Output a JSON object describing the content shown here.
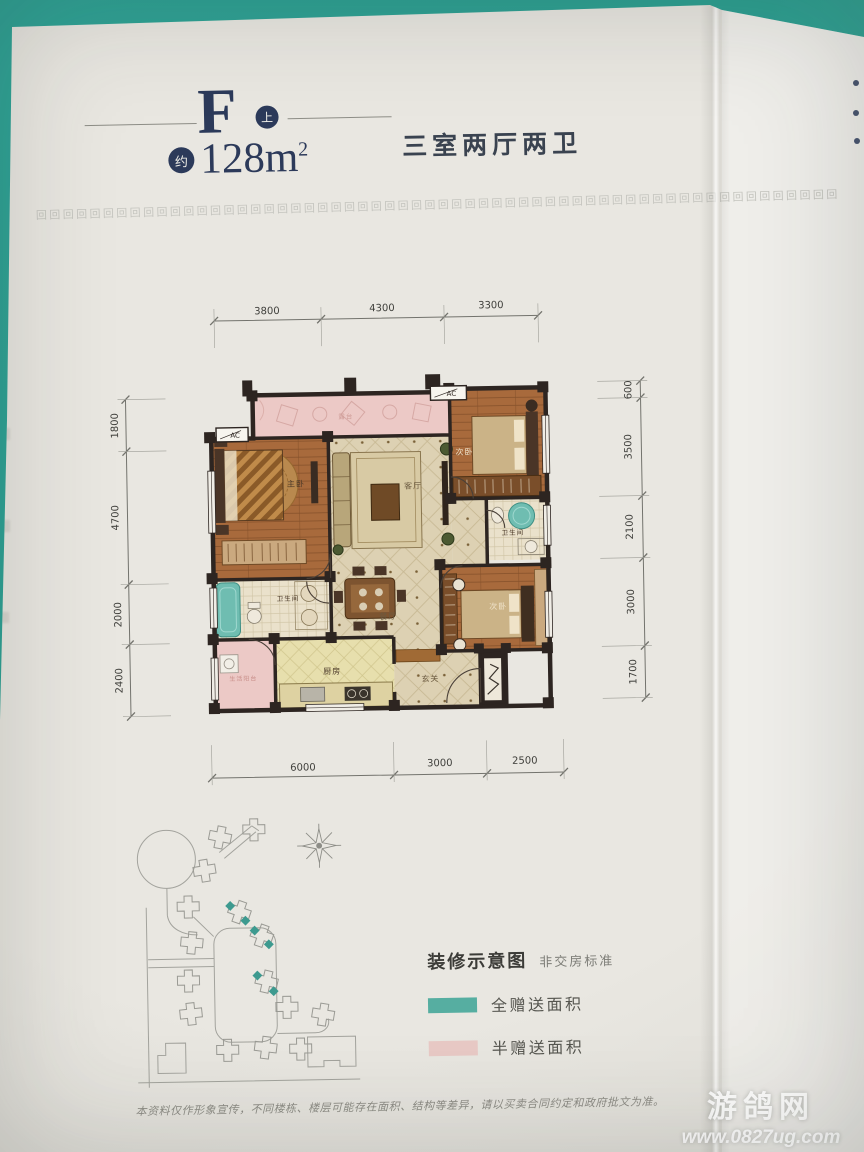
{
  "page": {
    "unit": {
      "letter": "F",
      "badge": "上",
      "approx_badge": "约",
      "area_value": "128m",
      "area_sup": "2",
      "layout_desc": "三室两厅两卫"
    },
    "border": {
      "char": "回",
      "count": 60
    },
    "dims": {
      "top": [
        "3800",
        "4300",
        "3300"
      ],
      "left": [
        "1800",
        "4700",
        "2000",
        "2400"
      ],
      "right": [
        "600",
        "3500",
        "2100",
        "3000",
        "1700"
      ],
      "bottom": [
        "6000",
        "3000",
        "2500"
      ]
    },
    "plan": {
      "ac": "AC",
      "rooms": {
        "terrace": "露台",
        "master": "主卧",
        "living": "客厅",
        "dining": "餐厅",
        "kitchen": "厨房",
        "entry": "玄关",
        "utility": "生活阳台",
        "bath_left": "卫生间",
        "bath_right": "卫生间",
        "bed_top_right": "次卧",
        "bed_bottom_right": "次卧"
      }
    },
    "legend": {
      "title": "装修示意图",
      "subtitle": "非交房标准",
      "items": [
        {
          "label": "全赠送面积",
          "color": "#56aea1"
        },
        {
          "label": "半赠送面积",
          "color": "#e8c9c5"
        }
      ]
    },
    "disclaimer": "本资料仅作形象宣传，不同楼栋、楼层可能存在面积、结构等差异，请以买卖合同约定和政府批文为准。",
    "watermark": {
      "name": "游鸽网",
      "url": "www.0827ug.com"
    },
    "colors": {
      "page": "#e9e7e1",
      "teal_band": "#2da092",
      "navy": "#2c3a5a",
      "gift_full": "#56aea1",
      "gift_half": "#e8c9c5",
      "wood": "#a86a3c",
      "wall": "#2d2521"
    }
  }
}
